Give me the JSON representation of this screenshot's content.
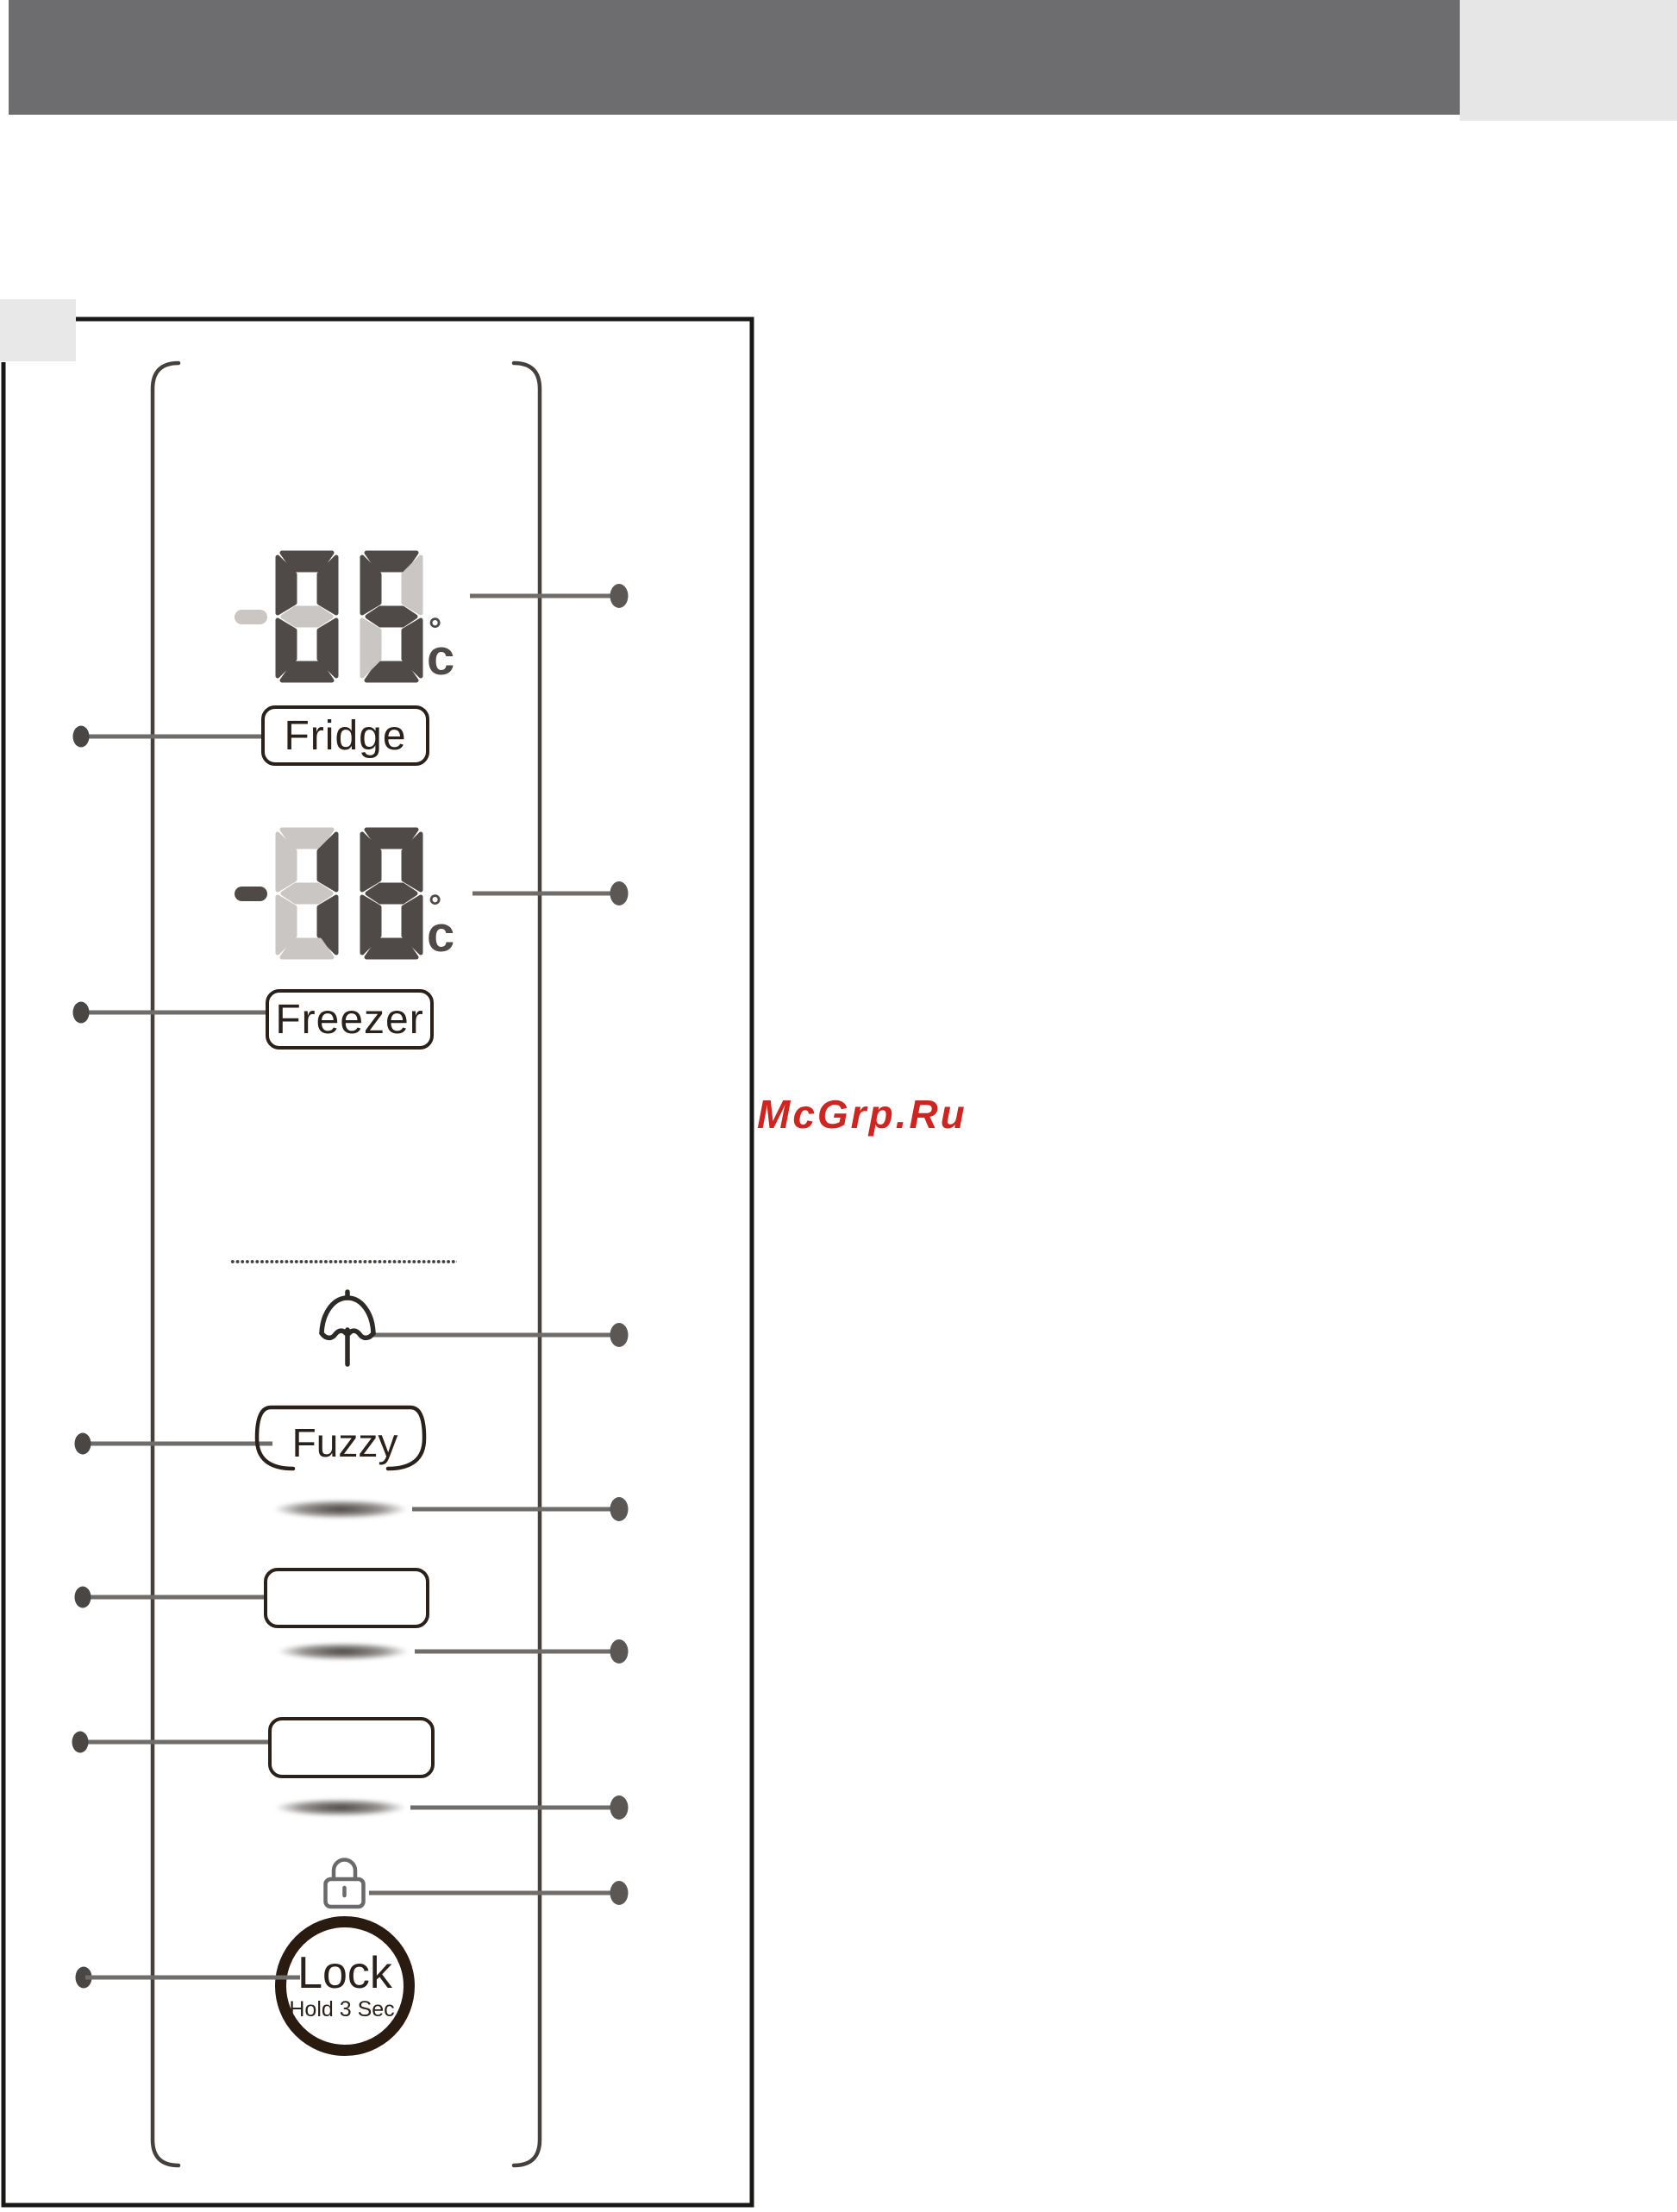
{
  "watermark": {
    "text": "McGrp.Ru",
    "color": "#cf2420"
  },
  "display": {
    "fridge": {
      "label": "Fridge",
      "value": "05",
      "minus_on": false,
      "unit_degree": "°",
      "unit_letter": "c"
    },
    "freezer": {
      "label": "Freezer",
      "value": "18",
      "minus_on": true,
      "unit_degree": "°",
      "unit_letter": "c"
    }
  },
  "buttons": {
    "fuzzy_label": "Fuzzy",
    "lock_label": "Lock",
    "lock_sublabel": "Hold 3 Sec."
  },
  "icons": {
    "umbrella": "umbrella-icon",
    "padlock": "padlock-icon"
  },
  "colors": {
    "seg_on": "#4f4a47",
    "seg_off": "#c9c6c4",
    "header_dark": "#6d6d6f",
    "header_light": "#e6e6e6",
    "line_gray": "#706c6a",
    "ink": "#2b211b",
    "red": "#cf2420"
  }
}
